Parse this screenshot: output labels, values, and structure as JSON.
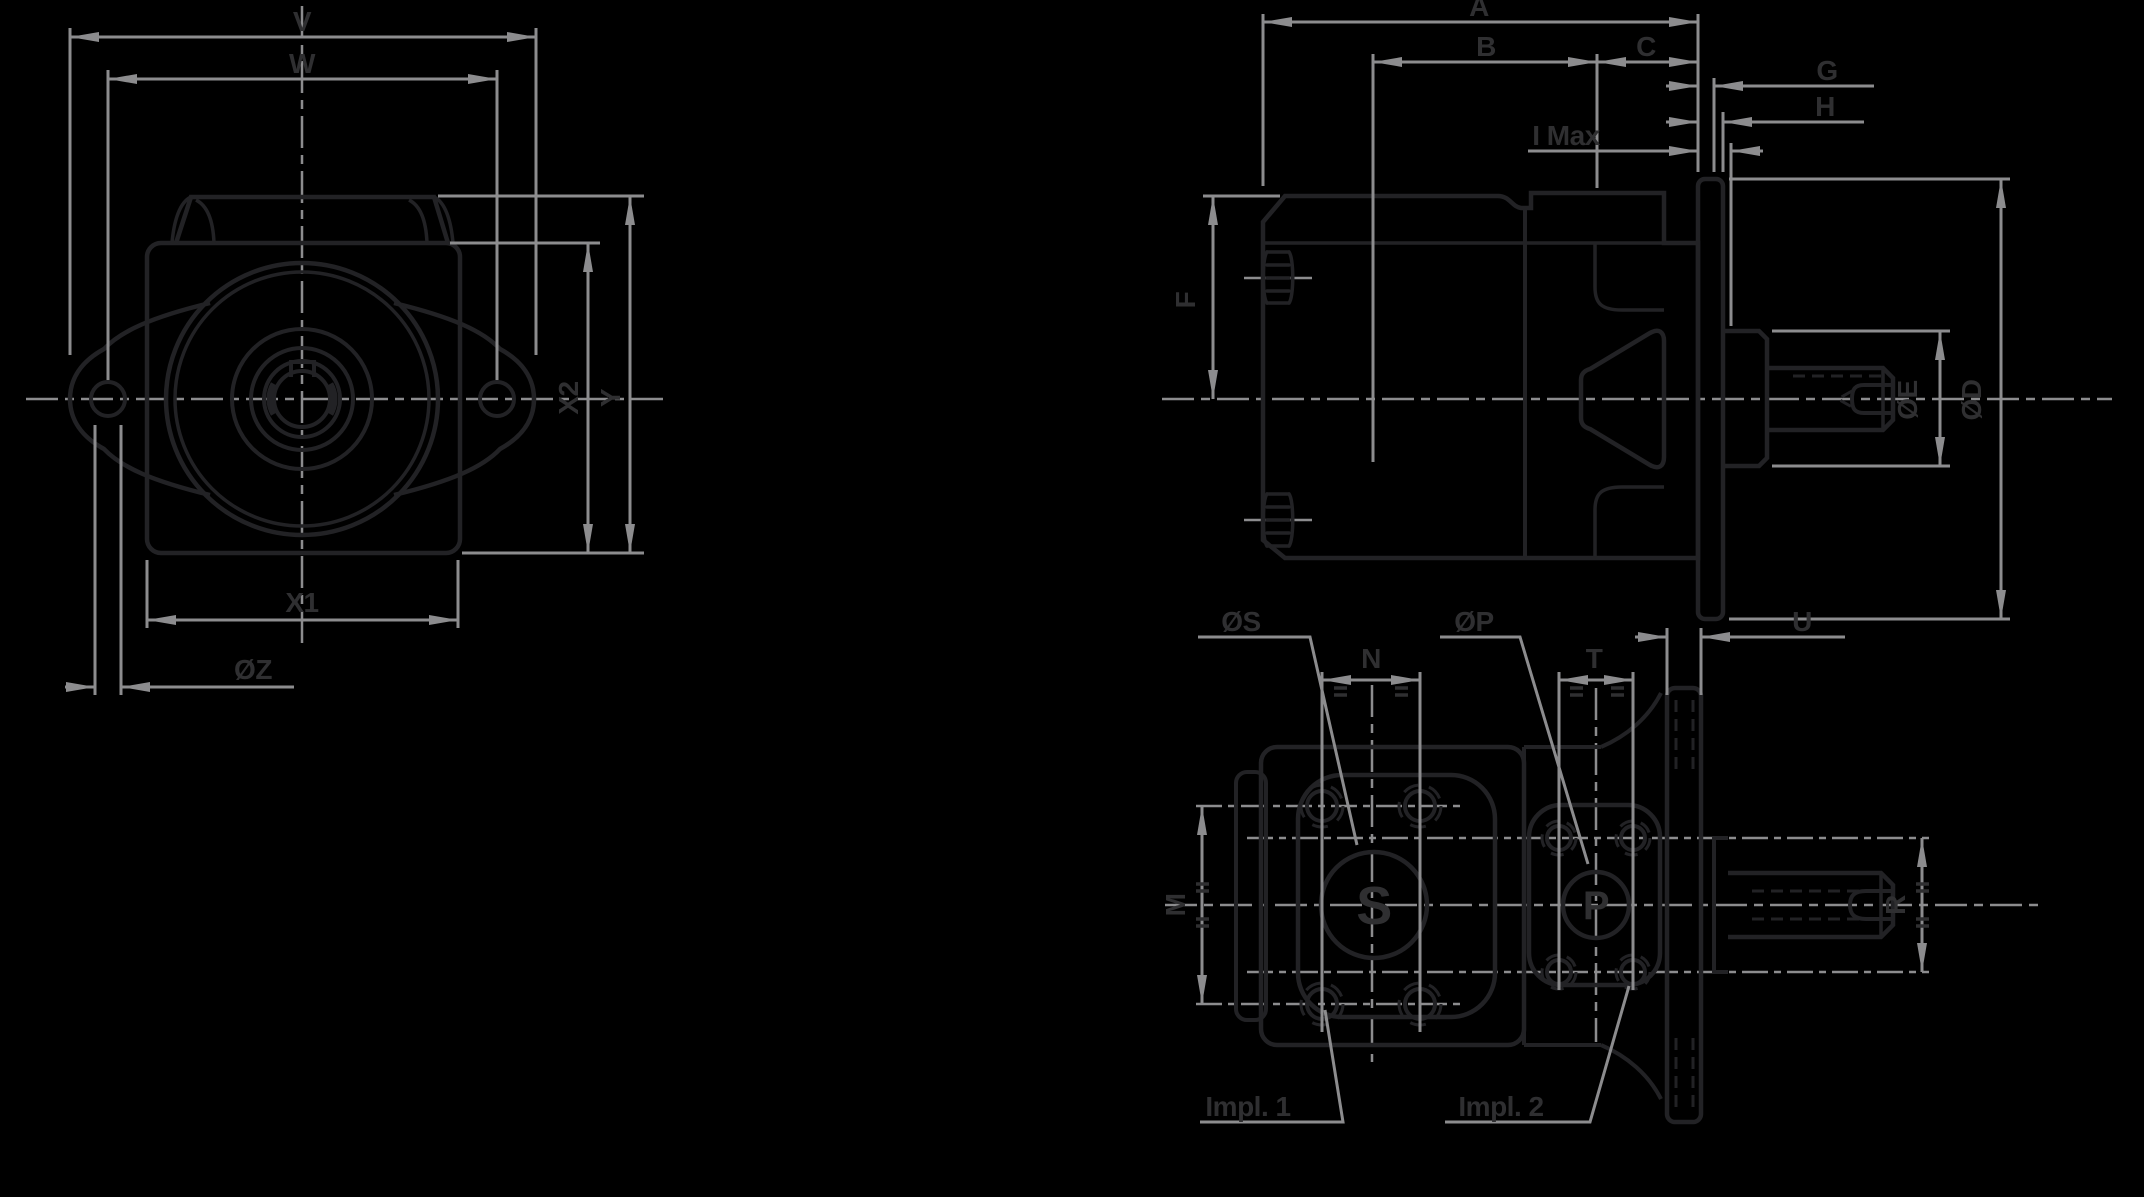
{
  "colors": {
    "background": "#000000",
    "part_line": "#222225",
    "dimension_line": "#8c8c8e",
    "label_text": "#2f2f31"
  },
  "drawing": {
    "front_view": {
      "labels": {
        "v": "V",
        "w": "W",
        "x2": "X2",
        "y": "Y",
        "x1": "X1",
        "z": "ØZ"
      }
    },
    "side_view": {
      "labels": {
        "a": "A",
        "b": "B",
        "c": "C",
        "g": "G",
        "h": "H",
        "i_max": "I Max",
        "f": "F",
        "e": "ØE",
        "d": "ØD"
      }
    },
    "rear_view": {
      "labels": {
        "s_dia": "ØS",
        "p_dia": "ØP",
        "n": "N",
        "t": "T",
        "u": "U",
        "m": "M",
        "r": "R",
        "s_port": "S",
        "p_port": "P",
        "impl_1": "Impl. 1",
        "impl_2": "Impl. 2"
      }
    },
    "symbols": {
      "equal_spacing_mark": "="
    }
  }
}
